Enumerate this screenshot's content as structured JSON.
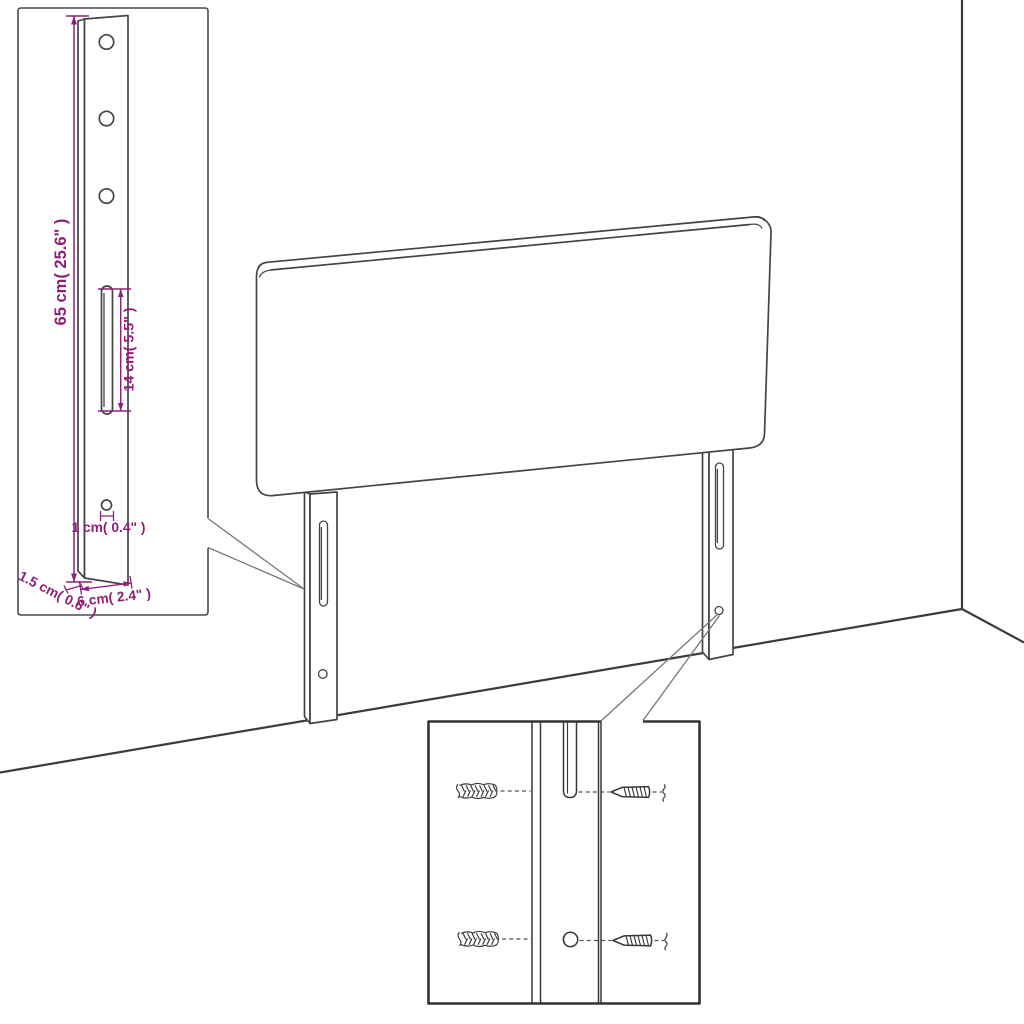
{
  "colors": {
    "line": "#454545",
    "dimension": "#8e2079",
    "background": "#ffffff"
  },
  "inset_detail": {
    "annotations": {
      "leg_height": "65 cm( 25.6\" )",
      "slot_length": "14 cm( 5.5\" )",
      "hole_diameter": "1 cm( 0.4\" )",
      "leg_thickness": "1.5 cm( 0.6\" )",
      "leg_width": "6 cm( 2.4\" )"
    }
  }
}
